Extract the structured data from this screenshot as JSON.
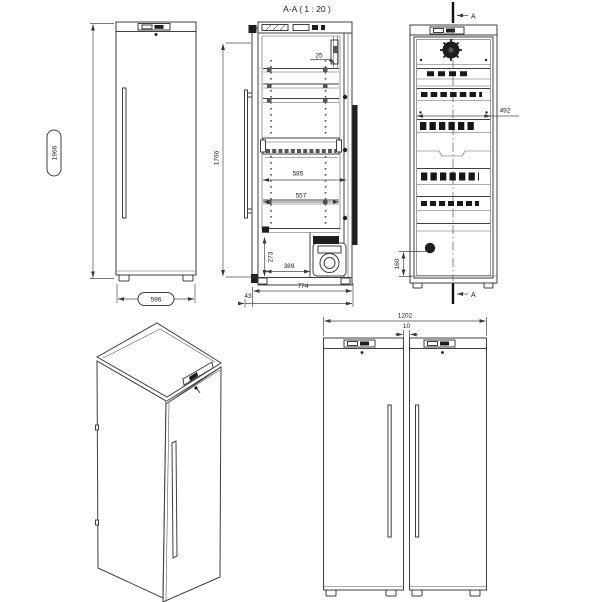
{
  "section_title": "A-A ( 1 : 20 )",
  "front_view": {
    "height": "1966",
    "width": "596"
  },
  "section_view": {
    "top_gap": "25",
    "interior_height": "1766",
    "depth_inner": "585",
    "depth_shelf": "557",
    "compartment_height": "273",
    "compartment_depth": "389",
    "overall_depth": "774",
    "handle_offset": "43"
  },
  "internal_view": {
    "interior_width": "492",
    "drain_height": "160",
    "cut_label_top": "A",
    "cut_label_bottom": "A"
  },
  "pair_view": {
    "overall_width": "1202",
    "gap": "10"
  }
}
